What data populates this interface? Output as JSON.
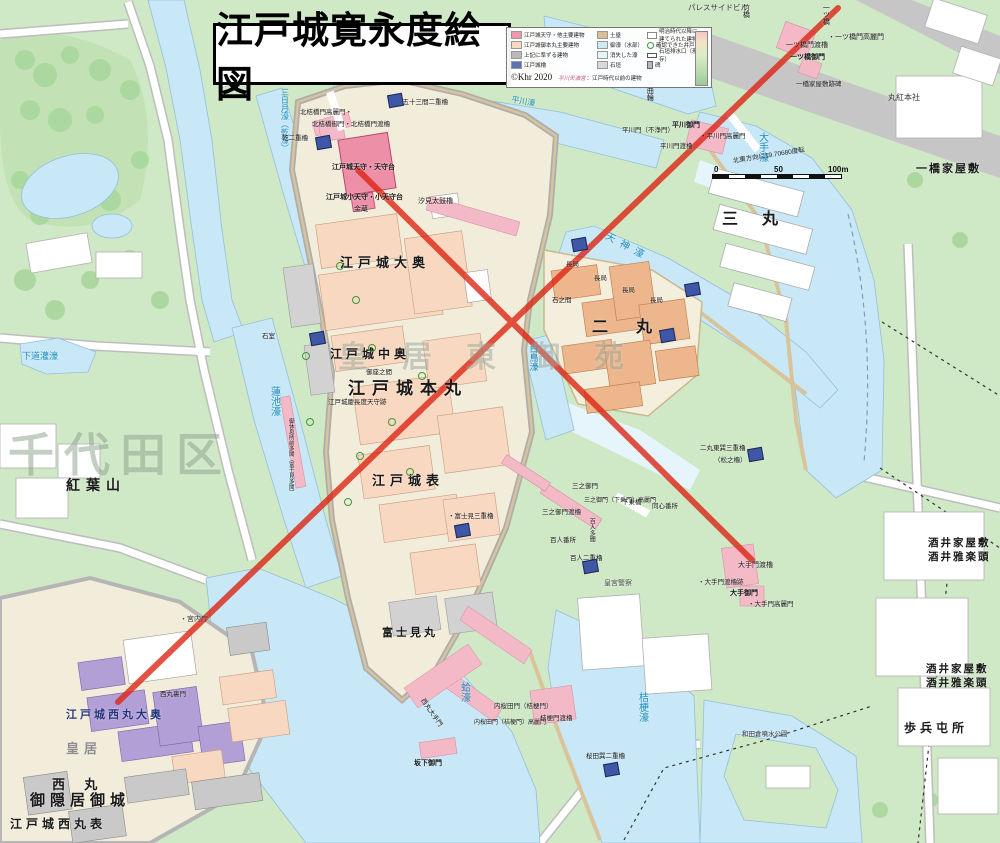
{
  "title": "江戸城寛永度絵図",
  "colors": {
    "park": "#cfe8c6",
    "moat": "#c9e8f7",
    "lost_moat": "#e6f4fb",
    "road_gray": "#c6c6c6",
    "castle_ground": "#f2ecda",
    "keep_pink": "#ee8fa8",
    "peach": "#f8d8c0",
    "orange": "#edb68c",
    "purple": "#b29fd6",
    "pink_band": "#f3b9c7",
    "turret_blue": "#3f57a7",
    "red_line": "#dd2211"
  },
  "legend": {
    "col1": [
      {
        "color": "#ef97ac",
        "label": "江戸城天守・他主要建物"
      },
      {
        "color": "#fbdabc",
        "label": "江戸城御本丸主要建物"
      },
      {
        "color": "#b9b9b9",
        "label": "上記に準ずる建物"
      },
      {
        "color": "#5a73b5",
        "label": "江戸城櫓"
      }
    ],
    "col2": [
      {
        "color": "#d9bd95",
        "label": "土塁"
      },
      {
        "color": "#cfe9f7",
        "label": "御濠（水部）"
      },
      {
        "color": "#e6f4fb",
        "label": "消失した濠"
      },
      {
        "color": "#d9d9d9",
        "label": "石垣"
      }
    ],
    "col3": [
      {
        "kind": "whitebox",
        "label": "明治時代以降に建てられた建物"
      },
      {
        "kind": "circle",
        "label": "確認できた井戸"
      },
      {
        "kind": "drain",
        "label": "石垣排水口（現存）"
      },
      {
        "kind": "stone",
        "label": "碑"
      }
    ],
    "note_name": "平川天満宮",
    "note_rest": "：江戸時代以前の建物",
    "copyright": "©Khr 2020"
  },
  "scale": {
    "ticks": [
      "0",
      "50",
      "100m"
    ],
    "rotation_note": "北東方向に19.70680度転"
  },
  "red_lines": [
    {
      "x1": 838,
      "y1": 8,
      "x2": 118,
      "y2": 702
    },
    {
      "x1": 358,
      "y1": 170,
      "x2": 752,
      "y2": 560
    }
  ],
  "turrets": [
    [
      316,
      136
    ],
    [
      388,
      94
    ],
    [
      572,
      238
    ],
    [
      685,
      283
    ],
    [
      660,
      329
    ],
    [
      748,
      448
    ],
    [
      583,
      560
    ],
    [
      604,
      763
    ],
    [
      455,
      524
    ],
    [
      310,
      332
    ]
  ],
  "wells": [
    [
      352,
      296
    ],
    [
      368,
      344
    ],
    [
      388,
      418
    ],
    [
      356,
      452
    ],
    [
      406,
      468
    ],
    [
      344,
      498
    ],
    [
      302,
      352
    ],
    [
      306,
      418
    ],
    [
      336,
      262
    ],
    [
      418,
      372
    ]
  ],
  "map_labels": [
    {
      "t": "千代田区",
      "x": 8,
      "y": 432,
      "s": 46,
      "c": "#93a893",
      "f": "serif",
      "w": 700,
      "ls": 10,
      "o": 0.55
    },
    {
      "t": "皇居東御苑",
      "x": 338,
      "y": 342,
      "s": 30,
      "c": "#9aa89a",
      "f": "serif",
      "w": 700,
      "ls": 34,
      "o": 0.5
    },
    {
      "t": "江戸城大奥",
      "x": 340,
      "y": 256,
      "s": 13,
      "f": "serif",
      "w": 700,
      "ls": 5
    },
    {
      "t": "江戸城中奥",
      "x": 330,
      "y": 348,
      "s": 12,
      "f": "serif",
      "w": 700,
      "ls": 4
    },
    {
      "t": "江戸城本丸",
      "x": 348,
      "y": 380,
      "s": 17,
      "f": "serif",
      "w": 700,
      "ls": 7
    },
    {
      "t": "江戸城表",
      "x": 372,
      "y": 474,
      "s": 13,
      "f": "serif",
      "w": 700,
      "ls": 5
    },
    {
      "t": "富士見丸",
      "x": 382,
      "y": 628,
      "s": 11,
      "f": "serif",
      "w": 700,
      "ls": 3
    },
    {
      "t": "二 丸",
      "x": 592,
      "y": 320,
      "s": 16,
      "f": "serif",
      "w": 700,
      "ls": 12
    },
    {
      "t": "三 丸",
      "x": 722,
      "y": 212,
      "s": 16,
      "f": "serif",
      "w": 700,
      "ls": 10
    },
    {
      "t": "紅葉山",
      "x": 66,
      "y": 480,
      "s": 14,
      "f": "serif",
      "w": 700,
      "ls": 6
    },
    {
      "t": "西 丸",
      "x": 52,
      "y": 778,
      "s": 13,
      "f": "serif",
      "w": 700,
      "ls": 8
    },
    {
      "t": "御隠居御城",
      "x": 30,
      "y": 794,
      "s": 15,
      "f": "serif",
      "w": 700,
      "ls": 5
    },
    {
      "t": "江戸城西丸表",
      "x": 10,
      "y": 818,
      "s": 12,
      "f": "serif",
      "w": 700,
      "ls": 4
    },
    {
      "t": "江戸城西丸大奥",
      "x": 66,
      "y": 710,
      "s": 11,
      "c": "#25357d",
      "f": "serif",
      "w": 700,
      "ls": 3
    },
    {
      "t": "皇居",
      "x": 66,
      "y": 742,
      "s": 13,
      "c": "#8d8d8d",
      "f": "serif",
      "w": 700,
      "ls": 5
    },
    {
      "t": "一橋家屋敷",
      "x": 916,
      "y": 164,
      "s": 11,
      "f": "serif",
      "w": 700,
      "ls": 2
    },
    {
      "t": "酒井家屋敷",
      "x": 928,
      "y": 538,
      "s": 10.5,
      "f": "serif",
      "w": 700,
      "ls": 2
    },
    {
      "t": "酒井雅楽頭",
      "x": 928,
      "y": 552,
      "s": 10.5,
      "f": "serif",
      "w": 700,
      "ls": 2
    },
    {
      "t": "酒井家屋敷",
      "x": 926,
      "y": 664,
      "s": 10.5,
      "f": "serif",
      "w": 700,
      "ls": 2
    },
    {
      "t": "酒井雅楽頭",
      "x": 926,
      "y": 678,
      "s": 10.5,
      "f": "serif",
      "w": 700,
      "ls": 2
    },
    {
      "t": "歩兵屯所",
      "x": 904,
      "y": 722,
      "s": 12,
      "f": "serif",
      "w": 700,
      "ls": 4
    },
    {
      "t": "丸紅本社",
      "x": 888,
      "y": 94,
      "s": 8,
      "c": "#333333"
    },
    {
      "t": "パレスサイドビル",
      "x": 688,
      "y": 4,
      "s": 7.5,
      "c": "#333333"
    },
    {
      "t": "江戸城天守・天守台",
      "x": 332,
      "y": 164,
      "s": 7,
      "w": 600
    },
    {
      "t": "江戸城小天守・小天守台",
      "x": 326,
      "y": 194,
      "s": 7,
      "w": 600
    },
    {
      "t": "金蔵",
      "x": 354,
      "y": 206,
      "s": 7
    },
    {
      "t": "汐見太鼓櫓",
      "x": 418,
      "y": 198,
      "s": 7
    },
    {
      "t": "三日月濠（乾濠）",
      "x": 280,
      "y": 88,
      "s": 8,
      "c": "#1e8cbe",
      "v": 1
    },
    {
      "t": "蓮池濠",
      "x": 268,
      "y": 386,
      "s": 10,
      "c": "#1e8cbe",
      "v": 1
    },
    {
      "t": "白鳥濠",
      "x": 528,
      "y": 344,
      "s": 9,
      "c": "#1e8cbe",
      "v": 1
    },
    {
      "t": "天神濠",
      "x": 608,
      "y": 232,
      "s": 10,
      "c": "#1e8cbe",
      "r": 28,
      "ls": 6
    },
    {
      "t": "大手濠",
      "x": 756,
      "y": 132,
      "s": 10,
      "c": "#1e8cbe",
      "v": 1
    },
    {
      "t": "桔梗濠",
      "x": 636,
      "y": 692,
      "s": 10,
      "c": "#1e8cbe",
      "v": 1
    },
    {
      "t": "蛤濠",
      "x": 458,
      "y": 682,
      "s": 10,
      "c": "#1e8cbe",
      "v": 1
    },
    {
      "t": "下道灌濠",
      "x": 22,
      "y": 352,
      "s": 9,
      "c": "#1e8cbe"
    },
    {
      "t": "平川濠",
      "x": 512,
      "y": 96,
      "s": 8,
      "c": "#1e8cbe",
      "r": 10
    },
    {
      "t": "帯曲輪",
      "x": 646,
      "y": 80,
      "s": 7,
      "v": 1
    },
    {
      "t": "竹橋",
      "x": 742,
      "y": 4,
      "s": 7,
      "v": 1
    },
    {
      "t": "一ツ橋",
      "x": 822,
      "y": 4,
      "s": 7,
      "v": 1
    },
    {
      "t": "・一ツ橋門高麗門",
      "x": 828,
      "y": 34,
      "s": 7
    },
    {
      "t": "一ツ橋門渡櫓",
      "x": 786,
      "y": 42,
      "s": 7
    },
    {
      "t": "一ツ橋御門",
      "x": 790,
      "y": 54,
      "s": 7,
      "w": 700
    },
    {
      "t": "一橋家屋敷跡碑",
      "x": 796,
      "y": 82,
      "s": 6.5
    },
    {
      "t": "北桔橋門高麗門・",
      "x": 300,
      "y": 110,
      "s": 6.5
    },
    {
      "t": "北桔橋御門・北桔橋門渡櫓",
      "x": 312,
      "y": 122,
      "s": 6.5
    },
    {
      "t": "乾二重櫓",
      "x": 282,
      "y": 136,
      "s": 6.5
    },
    {
      "t": "・五十三間二重櫓",
      "x": 396,
      "y": 100,
      "s": 6.5
    },
    {
      "t": "平川門（不浄門）",
      "x": 622,
      "y": 128,
      "s": 6.5
    },
    {
      "t": "平川御門",
      "x": 672,
      "y": 122,
      "s": 7,
      "w": 700
    },
    {
      "t": "・平川門高麗門",
      "x": 700,
      "y": 134,
      "s": 6.5
    },
    {
      "t": "平川門渡櫓",
      "x": 660,
      "y": 144,
      "s": 6.5
    },
    {
      "t": "大手門渡櫓",
      "x": 738,
      "y": 562,
      "s": 7
    },
    {
      "t": "・大手門渡櫓跡",
      "x": 698,
      "y": 580,
      "s": 6.5
    },
    {
      "t": "大手御門",
      "x": 730,
      "y": 590,
      "s": 7,
      "w": 700
    },
    {
      "t": "・大手門高麗門",
      "x": 748,
      "y": 602,
      "s": 6.5
    },
    {
      "t": "三之御門",
      "x": 572,
      "y": 484,
      "s": 6.5
    },
    {
      "t": "三之御門（下乗門）高麗門",
      "x": 584,
      "y": 498,
      "s": 6
    },
    {
      "t": "三之御門渡櫓",
      "x": 542,
      "y": 510,
      "s": 6.5
    },
    {
      "t": "下乗橋",
      "x": 622,
      "y": 500,
      "s": 6.5
    },
    {
      "t": "百人番所",
      "x": 550,
      "y": 538,
      "s": 6.5
    },
    {
      "t": "百人多聞",
      "x": 588,
      "y": 518,
      "s": 6,
      "v": 1
    },
    {
      "t": "百人二重櫓",
      "x": 570,
      "y": 556,
      "s": 6.5
    },
    {
      "t": "同心番所",
      "x": 652,
      "y": 504,
      "s": 6.5
    },
    {
      "t": "皇宮警察",
      "x": 604,
      "y": 580,
      "s": 7,
      "c": "#555555"
    },
    {
      "t": "・宮内庁",
      "x": 180,
      "y": 616,
      "s": 7,
      "c": "#333333"
    },
    {
      "t": "西丸裏門",
      "x": 160,
      "y": 692,
      "s": 6.5
    },
    {
      "t": "内桜田門（桔梗門）",
      "x": 494,
      "y": 704,
      "s": 6.5
    },
    {
      "t": "内桜田門（桔梗門）高麗門",
      "x": 474,
      "y": 720,
      "s": 6
    },
    {
      "t": "桔梗門渡櫓",
      "x": 540,
      "y": 716,
      "s": 6.5
    },
    {
      "t": "桜田巽二重櫓",
      "x": 586,
      "y": 754,
      "s": 6.5
    },
    {
      "t": "坂下御門",
      "x": 414,
      "y": 760,
      "s": 7,
      "w": 700
    },
    {
      "t": "石室",
      "x": 262,
      "y": 334,
      "s": 6.5
    },
    {
      "t": "御休息所前多聞（富士見多聞）",
      "x": 287,
      "y": 418,
      "s": 5.5,
      "v": 1
    },
    {
      "t": "・富士見三重櫓",
      "x": 448,
      "y": 514,
      "s": 6.5
    },
    {
      "t": "江戸城慶長度天守跡",
      "x": 328,
      "y": 400,
      "s": 6.5
    },
    {
      "t": "御座之間",
      "x": 366,
      "y": 370,
      "s": 6.5
    },
    {
      "t": "二丸東巽三重櫓",
      "x": 700,
      "y": 446,
      "s": 6.5
    },
    {
      "t": "（松之櫓）",
      "x": 714,
      "y": 458,
      "s": 6.5
    },
    {
      "t": "長局",
      "x": 566,
      "y": 262,
      "s": 6.5
    },
    {
      "t": "長局",
      "x": 594,
      "y": 276,
      "s": 6.5
    },
    {
      "t": "長局",
      "x": 622,
      "y": 288,
      "s": 6.5
    },
    {
      "t": "長局",
      "x": 650,
      "y": 298,
      "s": 6.5
    },
    {
      "t": "石之間",
      "x": 552,
      "y": 298,
      "s": 6.5
    },
    {
      "t": "西丸大手門",
      "x": 424,
      "y": 698,
      "s": 6.5,
      "r": 55
    },
    {
      "t": "和田倉噴水公園",
      "x": 742,
      "y": 732,
      "s": 6.5,
      "c": "#333333"
    }
  ]
}
